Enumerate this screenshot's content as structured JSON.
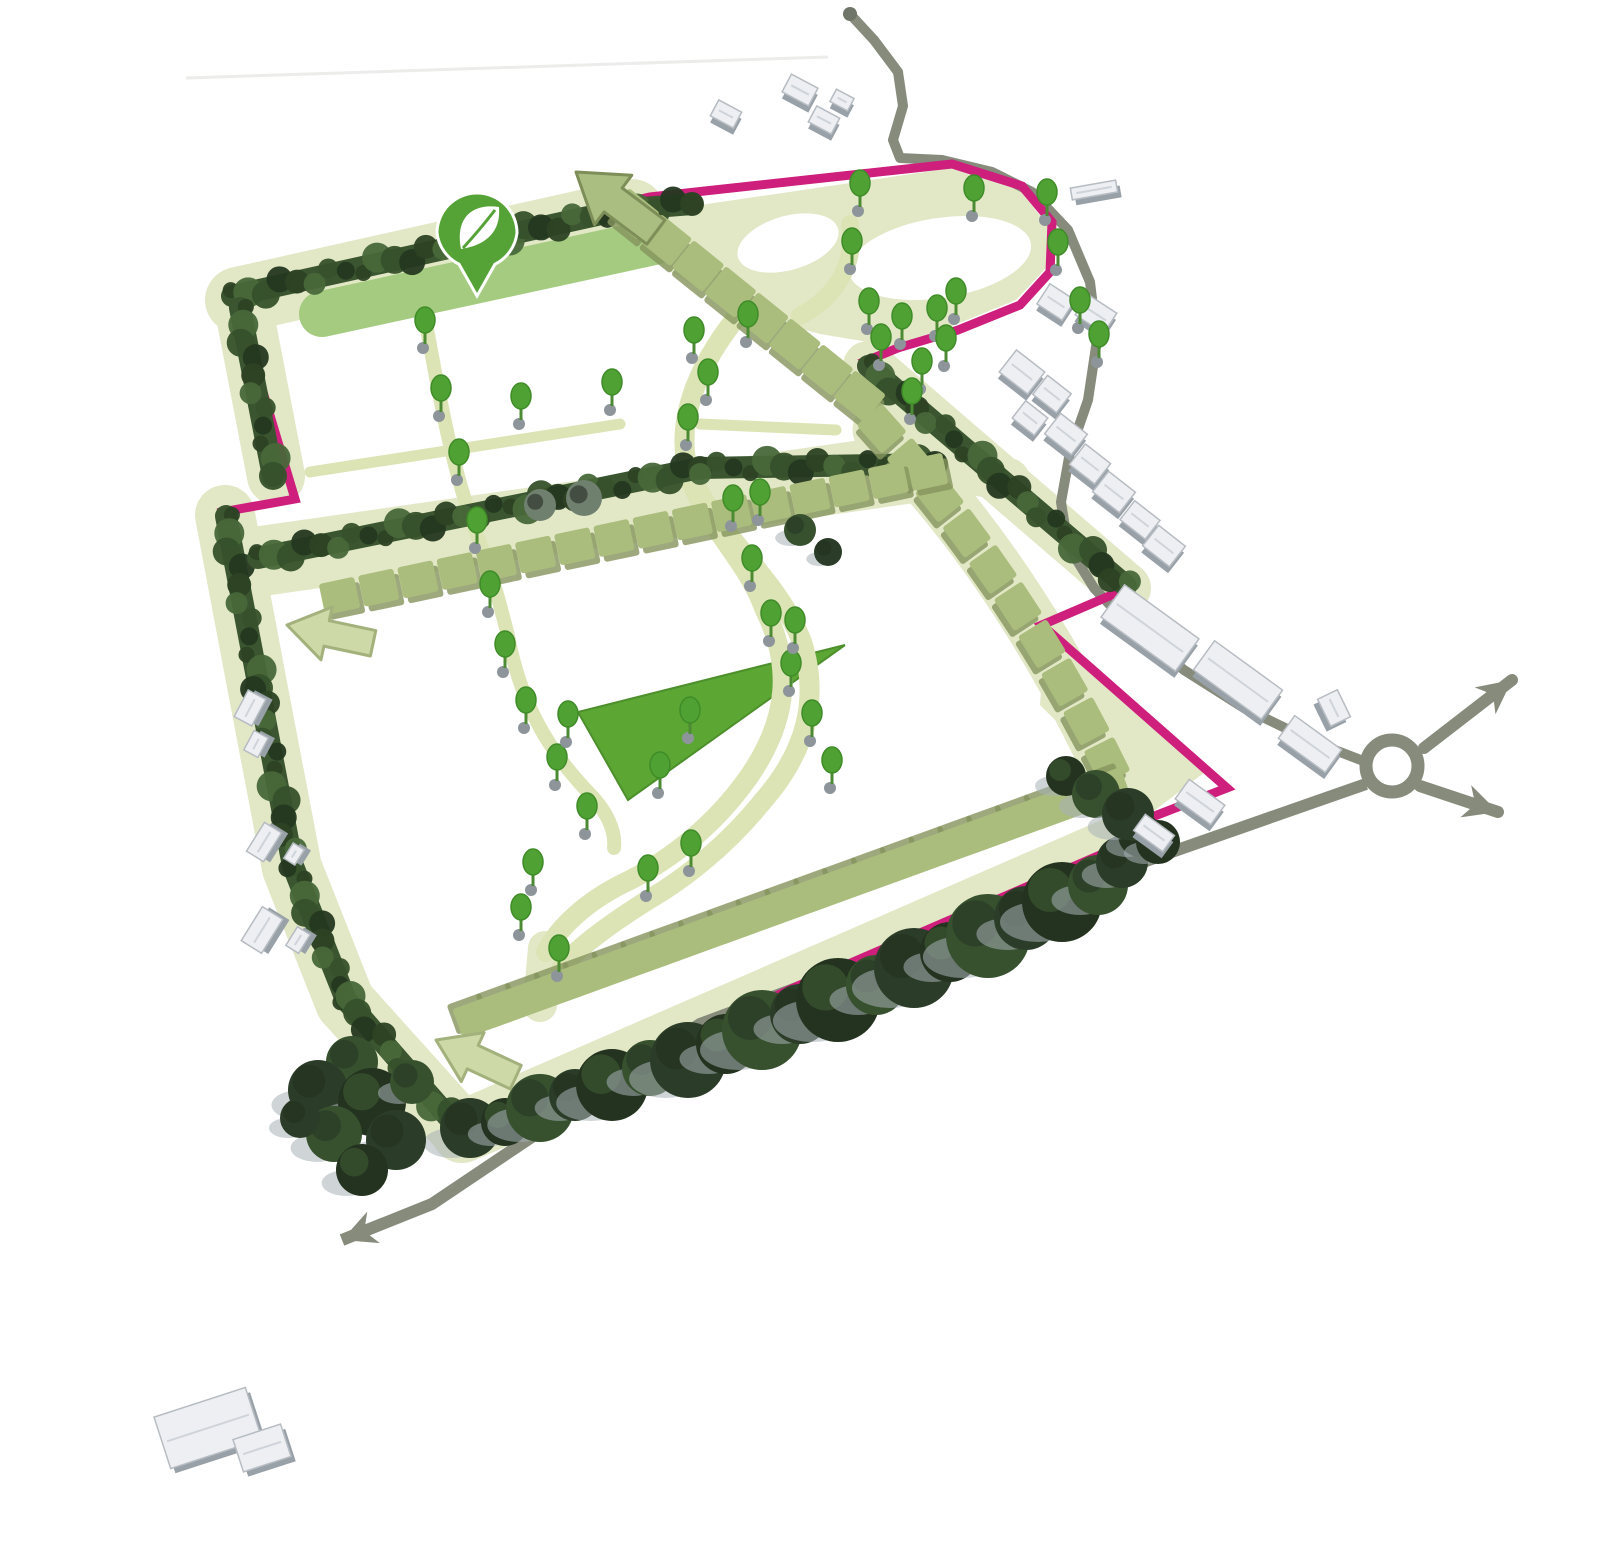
{
  "meta": {
    "title": "Development site masterplan diagram (3D aerial illustrative plan)",
    "description": "Illustrative landscape masterplan: pink site boundary, hedgerows, plot squares, avenue trees, internal loop paths, surrounding roads with roundabout and direction arrows, existing grey buildings, green amenity pin marker"
  },
  "plan": {
    "canvas": {
      "width": 1600,
      "height": 1552,
      "background": "#ffffff"
    },
    "colors": {
      "boundary_pink": "#ce1f7d",
      "verge": "#e2e8c6",
      "verge_dark": "#dce4b6",
      "green_strip": "#a5cb80",
      "green_bright": "#5ca634",
      "plot_olive": "#abbd7d",
      "plot_shadow": "#85945c",
      "hedge": "#3a5530",
      "hedge_blobs": [
        "#2c4224",
        "#48683a",
        "#36512b",
        "#243820"
      ],
      "dark_tree": [
        "#2b3d28",
        "#24331f",
        "#37512e"
      ],
      "tree_crown": "#4fa134",
      "tree_crown_edge": "#3f8c28",
      "tree_base_dot": "#8d959b",
      "grey_tree": "#70806f",
      "road": "#868b7c",
      "building_wall": "#99a1a8",
      "building_roof": "#edeff2",
      "building_edge": "#b6bcc2",
      "pin_green": "#55a337",
      "arrow_olive_fill": "#aabe82",
      "arrow_olive_edge": "#7e8e58",
      "arrow_pale_fill": "#cdd9a6",
      "arrow_pale_edge": "#a3b17c",
      "shadow_grey": "#a8b1b6",
      "faint_line": "#ececea"
    },
    "decor_top_line": {
      "x1": 186,
      "y1": 78,
      "x2": 828,
      "y2": 57,
      "width": 3
    },
    "boundary": {
      "width": 9,
      "points": [
        [
          230,
          291
        ],
        [
          650,
          197
        ],
        [
          952,
          164
        ],
        [
          1022,
          186
        ],
        [
          1052,
          222
        ],
        [
          1050,
          272
        ],
        [
          1020,
          305
        ],
        [
          958,
          330
        ],
        [
          898,
          348
        ],
        [
          866,
          361
        ],
        [
          1008,
          477
        ],
        [
          1128,
          588
        ],
        [
          1042,
          625
        ],
        [
          1227,
          788
        ],
        [
          1152,
          817
        ],
        [
          1137,
          839
        ],
        [
          800,
          985
        ],
        [
          463,
          1140
        ],
        [
          340,
          1000
        ],
        [
          290,
          862
        ],
        [
          256,
          690
        ],
        [
          222,
          512
        ],
        [
          295,
          499
        ],
        [
          263,
          392
        ]
      ]
    },
    "verges": [
      {
        "name": "verge-top-band",
        "mode": "stroke",
        "d": "M238,300 L632,212",
        "width": 66
      },
      {
        "name": "verge-left-upper",
        "mode": "stroke",
        "d": "M243,305 L276,476",
        "width": 58
      },
      {
        "name": "verge-left-lower",
        "mode": "stroke",
        "d": "M225,515 L258,690 L292,868 L345,1002 L462,1132",
        "width": 60
      },
      {
        "name": "verge-bottom",
        "mode": "stroke",
        "d": "M462,1132 L1133,840",
        "width": 62
      },
      {
        "name": "verge-northeast",
        "mode": "stroke",
        "d": "M868,366 L1126,588",
        "width": 50
      },
      {
        "name": "verge-middle-band",
        "mode": "stroke",
        "d": "M255,562 L940,464",
        "width": 70
      },
      {
        "name": "verge-middle-ext",
        "mode": "stroke",
        "d": "M935,465 L1008,480",
        "width": 44
      },
      {
        "name": "verge-plot-curve",
        "mode": "stroke",
        "d": "M880,430 Q1010,560 1105,758",
        "width": 55
      },
      {
        "name": "verge-top-lobe",
        "mode": "fill",
        "d": "M612,218 L952,168 L1020,190 L1048,226 L1046,268 L1016,300 L952,326 L892,346 L820,334 L740,312 L664,268 Z"
      },
      {
        "name": "verge-southeast-notch",
        "mode": "fill",
        "d": "M1045,628 L1205,772 L1150,814 L1040,705 Z"
      },
      {
        "name": "verge-bottom-connector",
        "mode": "stroke",
        "d": "M545,948 L540,1005",
        "width": 34
      }
    ],
    "islands": [
      {
        "name": "loop-island-large",
        "cx": 940,
        "cy": 258,
        "rx": 92,
        "ry": 40,
        "rot": -9
      },
      {
        "name": "loop-island-small",
        "cx": 788,
        "cy": 243,
        "rx": 52,
        "ry": 27,
        "rot": -16
      }
    ],
    "green_strip": {
      "d": "M322,314 L654,242",
      "width": 46
    },
    "green_triangle": {
      "points": [
        [
          845,
          645
        ],
        [
          578,
          712
        ],
        [
          628,
          800
        ]
      ]
    },
    "s_paths": [
      {
        "name": "loop-path-west",
        "d": "M745,307 C700,360 672,420 690,478 C706,526 748,562 764,608 C792,664 790,718 748,778 C714,826 668,862 622,884 C586,902 558,928 546,952",
        "width": 20
      },
      {
        "name": "loop-path-east",
        "d": "M688,470 C718,538 778,578 802,642 C820,700 806,752 762,802 C728,844 686,878 648,900 C616,920 582,944 562,966",
        "width": 20
      },
      {
        "name": "loop-path-northwest",
        "d": "M425,318 C440,400 452,470 478,538 C494,580 502,612 508,636 C520,700 546,748 588,792 C606,810 616,830 614,848",
        "width": 14
      },
      {
        "name": "loop-crossover",
        "d": "M800,316 C838,296 856,262 850,224",
        "width": 18
      }
    ],
    "thin_paths": [
      {
        "name": "plot-path-west",
        "d": "M310,472 L620,424",
        "width": 11
      },
      {
        "name": "plot-path-east",
        "d": "M700,424 L836,430",
        "width": 11
      }
    ],
    "roads": {
      "width_main": 10,
      "width_south": 12,
      "main_pts": [
        [
          850,
          14
        ],
        [
          874,
          40
        ],
        [
          898,
          72
        ],
        [
          903,
          106
        ],
        [
          893,
          140
        ],
        [
          900,
          158
        ],
        [
          942,
          160
        ],
        [
          992,
          172
        ],
        [
          1032,
          192
        ],
        [
          1068,
          230
        ],
        [
          1090,
          282
        ],
        [
          1097,
          340
        ],
        [
          1088,
          400
        ],
        [
          1070,
          452
        ],
        [
          1061,
          502
        ],
        [
          1068,
          546
        ],
        [
          1094,
          588
        ],
        [
          1132,
          628
        ],
        [
          1184,
          670
        ],
        [
          1244,
          708
        ],
        [
          1314,
          742
        ],
        [
          1366,
          762
        ]
      ],
      "south_pts": [
        [
          1366,
          784
        ],
        [
          1000,
          912
        ],
        [
          700,
          1024
        ],
        [
          432,
          1204
        ],
        [
          342,
          1240
        ]
      ],
      "south_has_head": true,
      "start_dot": {
        "x": 850,
        "y": 14,
        "r": 7
      },
      "roundabout": {
        "cx": 1392,
        "cy": 766,
        "r": 26,
        "ring": 13
      },
      "exit_arrows": [
        {
          "name": "roundabout-exit-northeast",
          "pts": [
            [
              1424,
              748
            ],
            [
              1512,
              680
            ]
          ]
        },
        {
          "name": "roundabout-exit-southeast",
          "pts": [
            [
              1420,
              786
            ],
            [
              1498,
              812
            ]
          ]
        }
      ]
    },
    "hedges": [
      {
        "name": "hedge-top",
        "d": [
          [
            232,
            296
          ],
          [
            606,
            213
          ]
        ]
      },
      {
        "name": "hedge-top-right",
        "d": [
          [
            618,
            210
          ],
          [
            692,
            204
          ]
        ]
      },
      {
        "name": "hedge-left-upper",
        "d": [
          [
            240,
            308
          ],
          [
            273,
            476
          ]
        ]
      },
      {
        "name": "hedge-left-lower",
        "d": [
          [
            226,
            516
          ],
          [
            259,
            688
          ],
          [
            293,
            866
          ],
          [
            346,
            1000
          ],
          [
            458,
            1128
          ]
        ]
      },
      {
        "name": "hedge-middle",
        "d": [
          [
            258,
            558
          ],
          [
            700,
            468
          ],
          [
            935,
            464
          ]
        ]
      },
      {
        "name": "hedge-northeast",
        "d": [
          [
            868,
            366
          ],
          [
            1126,
            586
          ]
        ]
      }
    ],
    "plot_rows": [
      {
        "name": "plot-row-north",
        "type": "line",
        "pts": [
          [
            632,
            216
          ],
          [
            858,
            398
          ]
        ],
        "count": 8,
        "size": 40
      },
      {
        "name": "plot-row-east-curve",
        "type": "quad",
        "pts": [
          [
            880,
            430
          ],
          [
            1015,
            582
          ],
          [
            1105,
            762
          ]
        ],
        "count": 10,
        "size": 38
      },
      {
        "name": "plot-row-middle",
        "type": "line",
        "pts": [
          [
            340,
            598
          ],
          [
            928,
            474
          ]
        ],
        "count": 16,
        "size": 36
      },
      {
        "name": "plot-row-south",
        "type": "line",
        "pts": [
          [
            1108,
            786
          ],
          [
            474,
            1016
          ]
        ],
        "count": 23,
        "size": 36
      }
    ],
    "dark_trees": [
      [
        470,
        1128,
        30
      ],
      [
        505,
        1122,
        24
      ],
      [
        540,
        1108,
        34
      ],
      [
        575,
        1095,
        26
      ],
      [
        612,
        1085,
        36
      ],
      [
        650,
        1068,
        28
      ],
      [
        688,
        1060,
        38
      ],
      [
        726,
        1044,
        30
      ],
      [
        762,
        1030,
        40
      ],
      [
        800,
        1014,
        30
      ],
      [
        838,
        1000,
        42
      ],
      [
        876,
        985,
        30
      ],
      [
        914,
        968,
        40
      ],
      [
        950,
        952,
        30
      ],
      [
        988,
        936,
        42
      ],
      [
        1026,
        918,
        32
      ],
      [
        1062,
        902,
        40
      ],
      [
        1098,
        885,
        30
      ],
      [
        1122,
        862,
        26
      ],
      [
        1140,
        835,
        22
      ],
      [
        352,
        1062,
        26
      ],
      [
        318,
        1090,
        30
      ],
      [
        372,
        1102,
        34
      ],
      [
        334,
        1134,
        28
      ],
      [
        396,
        1140,
        30
      ],
      [
        362,
        1170,
        26
      ],
      [
        412,
        1082,
        22
      ],
      [
        300,
        1118,
        20
      ],
      [
        1066,
        776,
        20
      ],
      [
        1096,
        794,
        24
      ],
      [
        1128,
        814,
        26
      ],
      [
        1158,
        842,
        22
      ],
      [
        800,
        530,
        16
      ],
      [
        828,
        552,
        14
      ]
    ],
    "grey_trees": [
      [
        540,
        505,
        16
      ],
      [
        584,
        498,
        18
      ]
    ],
    "trees": [
      [
        425,
        320
      ],
      [
        441,
        388
      ],
      [
        459,
        452
      ],
      [
        477,
        520
      ],
      [
        521,
        396
      ],
      [
        612,
        382
      ],
      [
        694,
        330
      ],
      [
        708,
        372
      ],
      [
        688,
        417
      ],
      [
        748,
        314
      ],
      [
        760,
        492
      ],
      [
        860,
        183
      ],
      [
        974,
        188
      ],
      [
        1047,
        192
      ],
      [
        1058,
        242
      ],
      [
        852,
        241
      ],
      [
        869,
        301
      ],
      [
        902,
        316
      ],
      [
        937,
        308
      ],
      [
        956,
        291
      ],
      [
        922,
        361
      ],
      [
        946,
        338
      ],
      [
        912,
        391
      ],
      [
        881,
        337
      ],
      [
        1080,
        300
      ],
      [
        1099,
        334
      ],
      [
        490,
        584
      ],
      [
        505,
        644
      ],
      [
        526,
        700
      ],
      [
        557,
        757
      ],
      [
        587,
        806
      ],
      [
        533,
        862
      ],
      [
        521,
        907
      ],
      [
        559,
        948
      ],
      [
        648,
        868
      ],
      [
        691,
        843
      ],
      [
        733,
        498
      ],
      [
        752,
        558
      ],
      [
        771,
        613
      ],
      [
        791,
        663
      ],
      [
        812,
        713
      ],
      [
        832,
        760
      ],
      [
        690,
        710
      ],
      [
        660,
        765
      ],
      [
        568,
        714
      ],
      [
        795,
        620
      ]
    ],
    "buildings": [
      [
        1022,
        372,
        36,
        28,
        38
      ],
      [
        1052,
        394,
        30,
        24,
        38
      ],
      [
        1030,
        418,
        28,
        22,
        38
      ],
      [
        1066,
        434,
        34,
        26,
        38
      ],
      [
        1090,
        464,
        32,
        26,
        38
      ],
      [
        1114,
        492,
        34,
        26,
        38
      ],
      [
        1140,
        520,
        32,
        24,
        38
      ],
      [
        1164,
        546,
        34,
        26,
        38
      ],
      [
        1056,
        302,
        30,
        24,
        33
      ],
      [
        1096,
        314,
        34,
        24,
        33
      ],
      [
        1094,
        190,
        46,
        12,
        -10
      ],
      [
        726,
        114,
        26,
        18,
        28
      ],
      [
        800,
        90,
        30,
        20,
        28
      ],
      [
        824,
        120,
        26,
        18,
        28
      ],
      [
        842,
        100,
        20,
        14,
        28
      ],
      [
        1150,
        628,
        92,
        40,
        36
      ],
      [
        1238,
        680,
        84,
        36,
        36
      ],
      [
        1310,
        744,
        58,
        28,
        36
      ],
      [
        1334,
        708,
        30,
        22,
        64
      ],
      [
        1200,
        802,
        44,
        24,
        36
      ],
      [
        1154,
        833,
        36,
        20,
        36
      ],
      [
        250,
        708,
        30,
        20,
        -62
      ],
      [
        256,
        744,
        22,
        16,
        -62
      ],
      [
        264,
        842,
        34,
        20,
        -58
      ],
      [
        294,
        854,
        18,
        13,
        -58
      ],
      [
        262,
        930,
        40,
        24,
        -58
      ],
      [
        298,
        940,
        22,
        15,
        -58
      ],
      [
        208,
        1428,
        96,
        54,
        -18
      ],
      [
        262,
        1448,
        50,
        34,
        -18
      ]
    ],
    "site_arrows": [
      {
        "name": "site-arrow-north-exit",
        "tip": [
          576,
          172
        ],
        "angle": 217,
        "len": 100,
        "head": 62,
        "shaft": 30,
        "fill": "#aabe82",
        "edge": "#7e8e58"
      },
      {
        "name": "site-arrow-west-exit",
        "tip": [
          287,
          625
        ],
        "angle": 192,
        "len": 88,
        "head": 54,
        "shaft": 26,
        "fill": "#cdd9a6",
        "edge": "#a3b17c"
      },
      {
        "name": "site-arrow-southwest-exit",
        "tip": [
          436,
          1040
        ],
        "angle": 205,
        "len": 88,
        "head": 54,
        "shaft": 26,
        "fill": "#cdd9a6",
        "edge": "#a3b17c"
      }
    ],
    "pin": {
      "x": 477,
      "y": 233,
      "r": 40,
      "tail_y": 296
    }
  }
}
